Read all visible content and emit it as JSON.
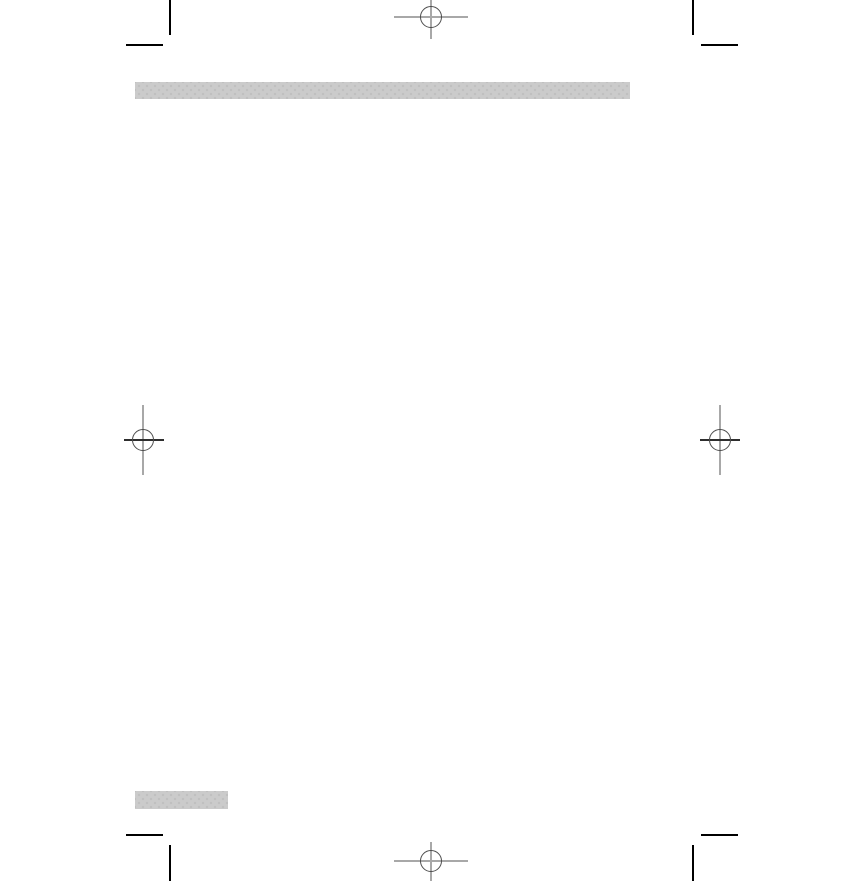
{
  "page": {
    "kind": "blank-print-document-page",
    "visible_text": ""
  },
  "colors": {
    "page_bg": "#ffffff",
    "bar_fill": "#cbcbcb",
    "bar_dot": "#c0c0c0",
    "crop_mark": "#000000",
    "reg_line": "#a8a8a8",
    "reg_line_dark": "#2e2e2e",
    "reg_circle": "#4d4d4d"
  },
  "placeholders": {
    "header_bar": {
      "label": ""
    },
    "footer_bar": {
      "label": ""
    }
  },
  "print_marks": {
    "crop_marks": [
      "top-left",
      "top-right",
      "bottom-left",
      "bottom-right"
    ],
    "registration_marks": [
      "top-center",
      "left-middle",
      "right-middle",
      "bottom-center"
    ]
  }
}
